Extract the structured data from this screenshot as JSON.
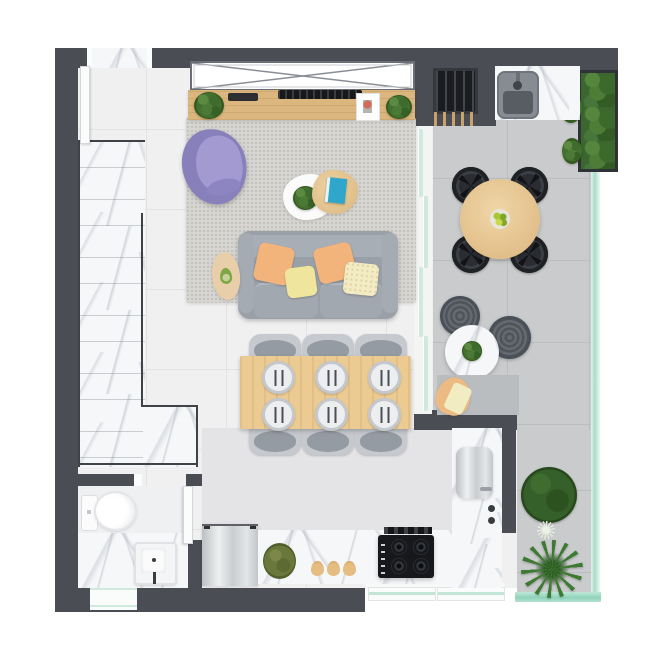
{
  "title": "apartment-floor-plan-top-view",
  "canvas": {
    "width": 650,
    "height": 650
  },
  "palette": {
    "wall": "#4a4d53",
    "wallDark": "#3a3d42",
    "floor": "#f0f0f1",
    "floorLine": "#e3e3e6",
    "kitchenFloor": "#e4e4e7",
    "balconyFloor": "#c9cbcc",
    "balconyLine": "#bbbdbf",
    "rug": "#d6d5d1",
    "marble": "#f6f7f9",
    "wood": "#dbb77f",
    "woodTable": "#eccb93",
    "mint": "#a7dbc8",
    "mintPale": "#cfeadd",
    "sofa": "#9aa0a8",
    "chair": "#c6c9ce",
    "purple": "#8780bb",
    "purpleLight": "#a29ad0",
    "orange": "#f3b47c",
    "yellow": "#efe59c",
    "cream": "#f2ebc4",
    "green": "#4a7a35",
    "steel": "#d7dadc",
    "black": "#17181b",
    "beige": "#ecba83",
    "pouf": "#5c6167",
    "white": "#fbfcfc"
  },
  "scene": {
    "items": [
      "entry-threshold-top",
      "white-door-leaf",
      "window-cross",
      "marble-staircase",
      "tv-sideboard",
      "sideboard-plants",
      "tv-top-view",
      "picture-card",
      "purple-armchair",
      "white-coffee-table",
      "wood-coffee-table",
      "blue-book",
      "gray-sofa",
      "orange-pillows",
      "yellow-pillows",
      "beige-side-table",
      "dining-table-6-seats",
      "place-settings",
      "gray-dining-chairs",
      "sliding-glass-door",
      "bbq-grill",
      "skewer-handles",
      "outdoor-sink",
      "hedge-planter",
      "glass-railing",
      "round-balcony-table",
      "black-outdoor-chairs",
      "fruit-bowl",
      "poufs",
      "round-marble-side-table",
      "beige-lounge-chair",
      "fern-plant",
      "dandelion-plant",
      "palm-plant",
      "toilet",
      "bathroom-sink",
      "bathroom-sliding-door",
      "entry-door-bottom",
      "dishwasher",
      "kitchen-counter",
      "counter-plant",
      "pears",
      "cooktop",
      "vent-strip",
      "steel-appliance",
      "counter-knobs",
      "kitchen-glass-windows"
    ]
  }
}
